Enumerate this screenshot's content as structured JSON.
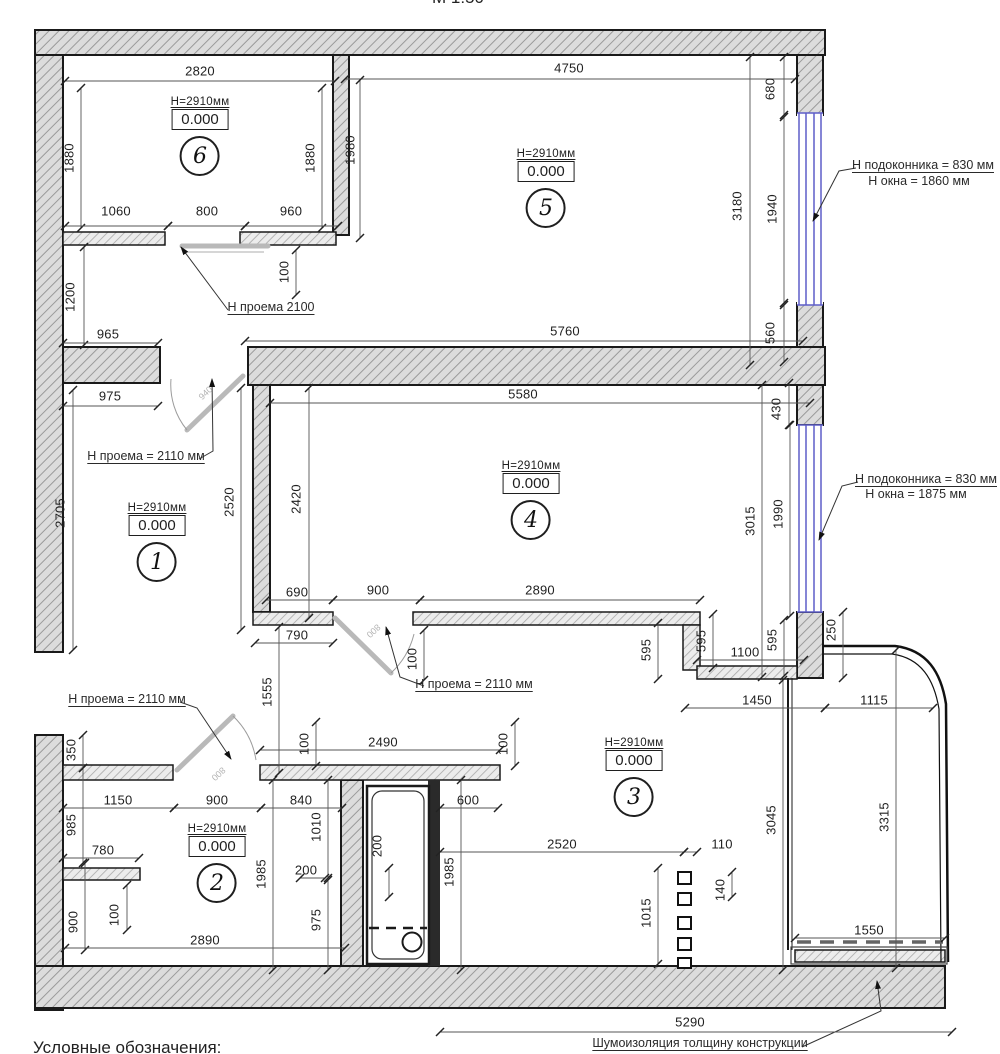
{
  "meta": {
    "scale_note": "М 1:50",
    "legend_heading": "Условные обозначения:"
  },
  "colors": {
    "wall_fill": "#dcdcdc",
    "wall_hatch": "#9a9a9a",
    "outline": "#1a1a1a",
    "window_blue": "#5e5ec8",
    "door_grey": "#b9b9b9",
    "dim_text": "#1f1f1f"
  },
  "rooms": [
    {
      "number": "6",
      "ceiling": "Н=2910мм",
      "level": "0.000",
      "cx": 200,
      "top": 96
    },
    {
      "number": "5",
      "ceiling": "Н=2910мм",
      "level": "0.000",
      "cx": 546,
      "top": 148
    },
    {
      "number": "1",
      "ceiling": "Н=2910мм",
      "level": "0.000",
      "cx": 157,
      "top": 502
    },
    {
      "number": "4",
      "ceiling": "Н=2910мм",
      "level": "0.000",
      "cx": 531,
      "top": 460
    },
    {
      "number": "2",
      "ceiling": "Н=2910мм",
      "level": "0.000",
      "cx": 217,
      "top": 823
    },
    {
      "number": "3",
      "ceiling": "Н=2910мм",
      "level": "0.000",
      "cx": 634,
      "top": 737
    }
  ],
  "dimensions": [
    {
      "v": "2820",
      "x": 200,
      "y": 71,
      "o": "h",
      "l": [
        65,
        81,
        335,
        81
      ]
    },
    {
      "v": "4750",
      "x": 569,
      "y": 68,
      "o": "h",
      "l": [
        345,
        79,
        795,
        79
      ]
    },
    {
      "v": "1880",
      "x": 69,
      "y": 158,
      "o": "v",
      "l": [
        81,
        88,
        81,
        228
      ]
    },
    {
      "v": "1880",
      "x": 310,
      "y": 158,
      "o": "v",
      "l": [
        322,
        88,
        322,
        228
      ]
    },
    {
      "v": "1980",
      "x": 350,
      "y": 150,
      "o": "v",
      "l": [
        360,
        80,
        360,
        238
      ]
    },
    {
      "v": "1060",
      "x": 116,
      "y": 211,
      "o": "h",
      "l": [
        65,
        226,
        168,
        226
      ]
    },
    {
      "v": "800",
      "x": 207,
      "y": 211,
      "o": "h",
      "l": [
        168,
        226,
        245,
        226
      ]
    },
    {
      "v": "960",
      "x": 291,
      "y": 211,
      "o": "h",
      "l": [
        245,
        226,
        338,
        226
      ]
    },
    {
      "v": "100",
      "x": 284,
      "y": 272,
      "o": "v",
      "l": [
        296,
        250,
        296,
        295
      ]
    },
    {
      "v": "1200",
      "x": 70,
      "y": 297,
      "o": "v",
      "l": [
        84,
        247,
        84,
        345
      ]
    },
    {
      "v": "965",
      "x": 108,
      "y": 334,
      "o": "h",
      "l": [
        63,
        343,
        158,
        343
      ]
    },
    {
      "v": "680",
      "x": 770,
      "y": 89,
      "o": "v",
      "l": [
        784,
        57,
        784,
        115
      ]
    },
    {
      "v": "3180",
      "x": 737,
      "y": 206,
      "o": "v",
      "l": [
        750,
        57,
        750,
        365
      ]
    },
    {
      "v": "1940",
      "x": 772,
      "y": 209,
      "o": "v",
      "l": [
        784,
        117,
        784,
        303
      ]
    },
    {
      "v": "560",
      "x": 770,
      "y": 333,
      "o": "v",
      "l": [
        784,
        305,
        784,
        362
      ]
    },
    {
      "v": "5760",
      "x": 565,
      "y": 331,
      "o": "h",
      "l": [
        245,
        341,
        803,
        341
      ]
    },
    {
      "v": "975",
      "x": 110,
      "y": 396,
      "o": "h",
      "l": [
        63,
        406,
        158,
        406
      ]
    },
    {
      "v": "5580",
      "x": 523,
      "y": 394,
      "o": "h",
      "l": [
        270,
        403,
        810,
        403
      ]
    },
    {
      "v": "430",
      "x": 776,
      "y": 409,
      "o": "v",
      "l": [
        789,
        383,
        789,
        425
      ]
    },
    {
      "v": "2705",
      "x": 60,
      "y": 513,
      "o": "v",
      "l": [
        73,
        390,
        73,
        650
      ]
    },
    {
      "v": "2520",
      "x": 229,
      "y": 502,
      "o": "v",
      "l": [
        241,
        388,
        241,
        630
      ]
    },
    {
      "v": "2420",
      "x": 296,
      "y": 499,
      "o": "v",
      "l": [
        309,
        388,
        309,
        618
      ]
    },
    {
      "v": "3015",
      "x": 750,
      "y": 521,
      "o": "v",
      "l": [
        762,
        385,
        762,
        677
      ]
    },
    {
      "v": "1990",
      "x": 778,
      "y": 514,
      "o": "v",
      "l": [
        790,
        425,
        790,
        616
      ]
    },
    {
      "v": "690",
      "x": 297,
      "y": 592,
      "o": "h",
      "l": [
        266,
        600,
        333,
        600
      ]
    },
    {
      "v": "900",
      "x": 378,
      "y": 590,
      "o": "h",
      "l": [
        333,
        600,
        420,
        600
      ]
    },
    {
      "v": "2890",
      "x": 540,
      "y": 590,
      "o": "h",
      "l": [
        420,
        600,
        700,
        600
      ]
    },
    {
      "v": "790",
      "x": 297,
      "y": 635,
      "o": "h",
      "l": [
        255,
        643,
        333,
        643
      ]
    },
    {
      "v": "1555",
      "x": 267,
      "y": 692,
      "o": "v",
      "l": [
        279,
        627,
        279,
        773
      ]
    },
    {
      "v": "100",
      "x": 412,
      "y": 659,
      "o": "v",
      "l": [
        424,
        630,
        424,
        680
      ]
    },
    {
      "v": "595",
      "x": 646,
      "y": 650,
      "o": "v",
      "l": [
        658,
        623,
        658,
        679
      ]
    },
    {
      "v": "595",
      "x": 701,
      "y": 641,
      "o": "v",
      "l": [
        713,
        614,
        713,
        668
      ]
    },
    {
      "v": "595",
      "x": 772,
      "y": 640,
      "o": "v",
      "l": [
        784,
        620,
        784,
        676
      ]
    },
    {
      "v": "1100",
      "x": 745,
      "y": 652,
      "o": "h",
      "l": [
        697,
        660,
        804,
        660
      ]
    },
    {
      "v": "250",
      "x": 831,
      "y": 630,
      "o": "v",
      "l": [
        843,
        612,
        843,
        678
      ]
    },
    {
      "v": "1450",
      "x": 757,
      "y": 700,
      "o": "h",
      "l": [
        685,
        708,
        825,
        708
      ]
    },
    {
      "v": "1115",
      "x": 874,
      "y": 700,
      "o": "h",
      "l": [
        825,
        708,
        933,
        708
      ]
    },
    {
      "v": "100",
      "x": 304,
      "y": 744,
      "o": "v",
      "l": [
        316,
        722,
        316,
        766
      ]
    },
    {
      "v": "2490",
      "x": 383,
      "y": 742,
      "o": "h",
      "l": [
        260,
        750,
        500,
        750
      ]
    },
    {
      "v": "100",
      "x": 503,
      "y": 744,
      "o": "v",
      "l": [
        515,
        722,
        515,
        766
      ]
    },
    {
      "v": "350",
      "x": 71,
      "y": 750,
      "o": "v",
      "l": [
        83,
        735,
        83,
        768
      ]
    },
    {
      "v": "1150",
      "x": 118,
      "y": 800,
      "o": "h",
      "l": [
        63,
        808,
        174,
        808
      ]
    },
    {
      "v": "900",
      "x": 217,
      "y": 800,
      "o": "h",
      "l": [
        174,
        808,
        261,
        808
      ]
    },
    {
      "v": "840",
      "x": 301,
      "y": 800,
      "o": "h",
      "l": [
        261,
        808,
        342,
        808
      ]
    },
    {
      "v": "600",
      "x": 468,
      "y": 800,
      "o": "h",
      "l": [
        440,
        808,
        498,
        808
      ]
    },
    {
      "v": "985",
      "x": 71,
      "y": 825,
      "o": "v",
      "l": [
        83,
        768,
        83,
        863
      ]
    },
    {
      "v": "780",
      "x": 103,
      "y": 850,
      "o": "h",
      "l": [
        63,
        858,
        139,
        858
      ]
    },
    {
      "v": "1010",
      "x": 316,
      "y": 827,
      "o": "v",
      "l": [
        328,
        780,
        328,
        878
      ]
    },
    {
      "v": "1985",
      "x": 261,
      "y": 874,
      "o": "v",
      "l": [
        273,
        780,
        273,
        970
      ]
    },
    {
      "v": "900",
      "x": 73,
      "y": 922,
      "o": "v",
      "l": [
        85,
        863,
        85,
        950
      ]
    },
    {
      "v": "100",
      "x": 114,
      "y": 915,
      "o": "v",
      "l": [
        127,
        885,
        127,
        930
      ]
    },
    {
      "v": "200",
      "x": 306,
      "y": 870,
      "o": "h",
      "l": [
        300,
        878,
        325,
        878
      ]
    },
    {
      "v": "975",
      "x": 316,
      "y": 920,
      "o": "v",
      "l": [
        328,
        880,
        328,
        970
      ]
    },
    {
      "v": "2890",
      "x": 205,
      "y": 940,
      "o": "h",
      "l": [
        65,
        948,
        345,
        948
      ]
    },
    {
      "v": "200",
      "x": 377,
      "y": 846,
      "o": "v",
      "l": [
        389,
        868,
        389,
        897
      ]
    },
    {
      "v": "1985",
      "x": 449,
      "y": 872,
      "o": "v",
      "l": [
        461,
        780,
        461,
        970
      ]
    },
    {
      "v": "2520",
      "x": 562,
      "y": 844,
      "o": "h",
      "l": [
        440,
        852,
        684,
        852
      ]
    },
    {
      "v": "110",
      "x": 722,
      "y": 844,
      "o": "h",
      "l": [
        684,
        852,
        697,
        852
      ]
    },
    {
      "v": "1015",
      "x": 646,
      "y": 913,
      "o": "v",
      "l": [
        658,
        868,
        658,
        964
      ]
    },
    {
      "v": "140",
      "x": 720,
      "y": 890,
      "o": "v",
      "l": [
        732,
        872,
        732,
        897
      ]
    },
    {
      "v": "3045",
      "x": 771,
      "y": 820,
      "o": "v",
      "l": [
        783,
        680,
        783,
        970
      ]
    },
    {
      "v": "3315",
      "x": 884,
      "y": 817,
      "o": "v",
      "l": [
        896,
        650,
        896,
        968
      ]
    },
    {
      "v": "1550",
      "x": 869,
      "y": 930,
      "o": "h",
      "l": [
        795,
        938,
        945,
        938
      ]
    },
    {
      "v": "5290",
      "x": 690,
      "y": 1022,
      "o": "h",
      "l": [
        440,
        1032,
        952,
        1032
      ]
    }
  ],
  "annotations": [
    {
      "t": "Н проема 2100",
      "x": 271,
      "y": 307,
      "u": true
    },
    {
      "t": "Н проема = 2110 мм",
      "x": 146,
      "y": 456,
      "u": true
    },
    {
      "t": "Н проема = 2110 мм",
      "x": 474,
      "y": 684,
      "u": true
    },
    {
      "t": "Н проема = 2110 мм",
      "x": 127,
      "y": 699,
      "u": true
    },
    {
      "t": "Н подоконника = 830 мм",
      "x": 923,
      "y": 165,
      "u": true
    },
    {
      "t": "Н окна = 1860 мм",
      "x": 919,
      "y": 181,
      "u": false
    },
    {
      "t": "Н подоконника = 830 мм",
      "x": 926,
      "y": 479,
      "u": true
    },
    {
      "t": "Н окна = 1875 мм",
      "x": 916,
      "y": 494,
      "u": false
    },
    {
      "t": "Шумоизоляция толщину конструкции",
      "x": 700,
      "y": 1043,
      "u": true
    },
    {
      "t": "Условные обозначения:",
      "x": 33,
      "y": 1038,
      "u": false,
      "align": "l",
      "big": true
    },
    {
      "t": "М 1:50",
      "x": 458,
      "y": -2,
      "u": false,
      "big": true
    }
  ],
  "door_labels": [
    {
      "t": "940",
      "x": 198,
      "y": 388,
      "r": -43
    },
    {
      "t": "800",
      "x": 366,
      "y": 626,
      "r": 137
    },
    {
      "t": "800",
      "x": 211,
      "y": 769,
      "r": 137
    }
  ]
}
